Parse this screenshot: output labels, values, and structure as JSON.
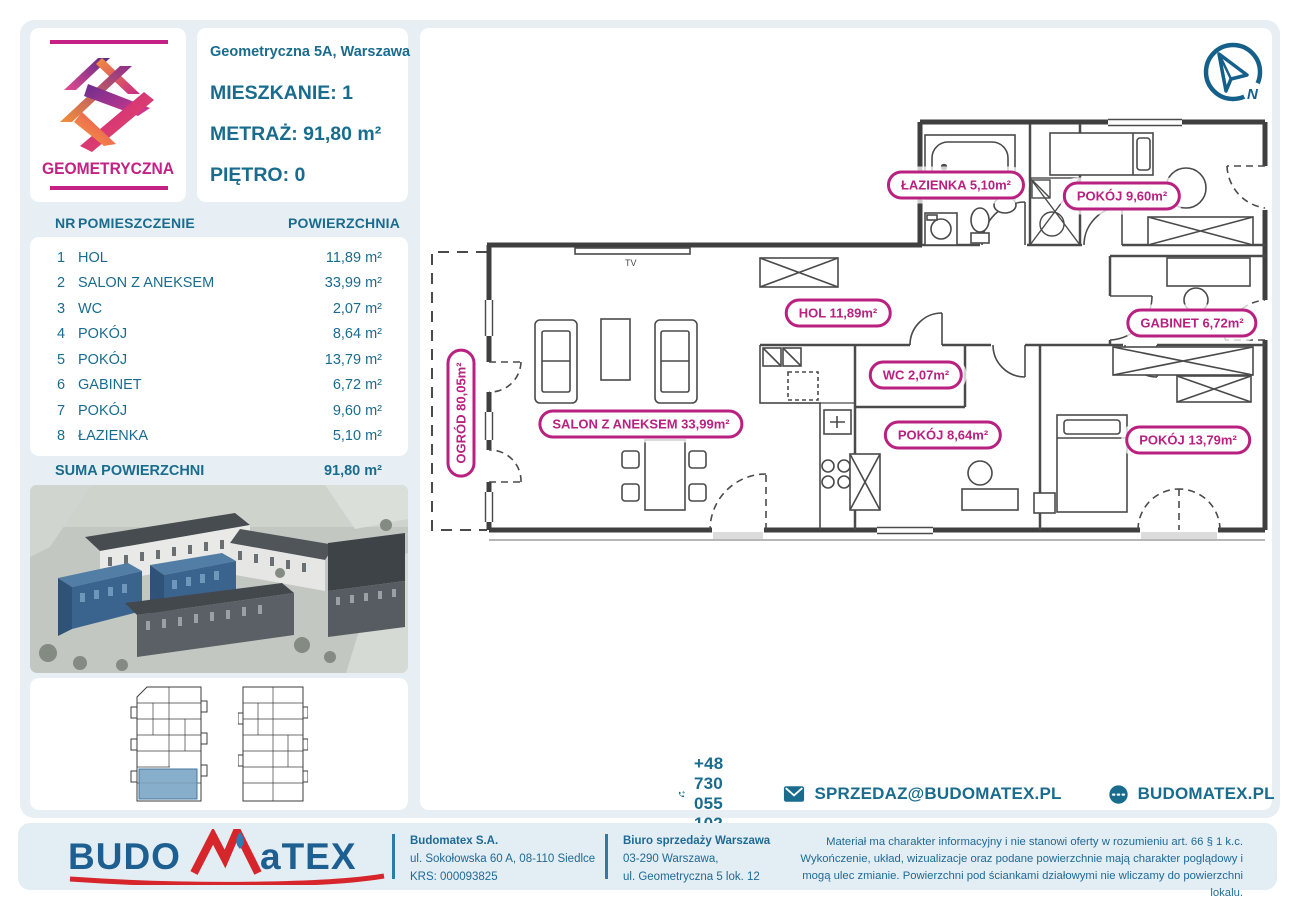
{
  "colors": {
    "teal": "#1a6c8e",
    "magenta": "#b92180",
    "panel_blue": "#e7eff5",
    "logo_blue": "#1d5f90",
    "logo_red": "#d6252b",
    "highlight_blue": "#3a648e"
  },
  "logo": {
    "brand": "GEOMETRYCZNA"
  },
  "header": {
    "address": "Geometryczna 5A, Warszawa",
    "apartment_label": "MIESZKANIE:",
    "apartment_value": "1",
    "metraz_label": "METRAŻ:",
    "metraz_value": "91,80 m²",
    "floor_label": "PIĘTRO:",
    "floor_value": "0"
  },
  "table": {
    "col_nr": "NR",
    "col_room": "POMIESZCZENIE",
    "col_area": "POWIERZCHNIA",
    "rows": [
      {
        "nr": "1",
        "name": "HOL",
        "area": "11,89 m²"
      },
      {
        "nr": "2",
        "name": "SALON Z ANEKSEM",
        "area": "33,99 m²"
      },
      {
        "nr": "3",
        "name": "WC",
        "area": "2,07 m²"
      },
      {
        "nr": "4",
        "name": "POKÓJ",
        "area": "8,64 m²"
      },
      {
        "nr": "5",
        "name": "POKÓJ",
        "area": "13,79 m²"
      },
      {
        "nr": "6",
        "name": "GABINET",
        "area": "6,72 m²"
      },
      {
        "nr": "7",
        "name": "POKÓJ",
        "area": "9,60 m²"
      },
      {
        "nr": "8",
        "name": "ŁAZIENKA",
        "area": "5,10 m²"
      }
    ],
    "sum_label": "SUMA POWIERZCHNI",
    "sum_value": "91,80 m²"
  },
  "plan": {
    "tv": "TV",
    "compass_n": "N",
    "labels": {
      "lazienka": "ŁAZIENKA 5,10m²",
      "pokoj9": "POKÓJ 9,60m²",
      "hol": "HOL 11,89m²",
      "gabinet": "GABINET 6,72m²",
      "wc": "WC 2,07m²",
      "salon": "SALON Z ANEKSEM 33,99m²",
      "pokoj8": "POKÓJ 8,64m²",
      "pokoj13": "POKÓJ 13,79m²",
      "ogrod": "OGRÓD 80,05m²"
    }
  },
  "contact": {
    "phone": "+48 730 055 102",
    "email": "SPRZEDAZ@BUDOMATEX.PL",
    "website": "BUDOMATEX.PL"
  },
  "footer": {
    "brand_left": "BUDO",
    "brand_right": "aTEX",
    "company_name": "Budomatex S.A.",
    "company_address": "ul. Sokołowska 60 A, 08-110 Siedlce",
    "company_krs": "KRS: 000093825",
    "office_name": "Biuro sprzedaży Warszawa",
    "office_line1": "03-290 Warszawa,",
    "office_line2": "ul. Geometryczna 5 lok. 12",
    "disclaimer": "Materiał ma charakter informacyjny i nie stanowi oferty w rozumieniu art. 66 § 1 k.c. Wykończenie, układ, wizualizacje oraz podane powierzchnie mają charakter poglądowy i mogą ulec zmianie. Powierzchni pod ściankami działowymi nie wliczamy do powierzchni lokalu."
  }
}
